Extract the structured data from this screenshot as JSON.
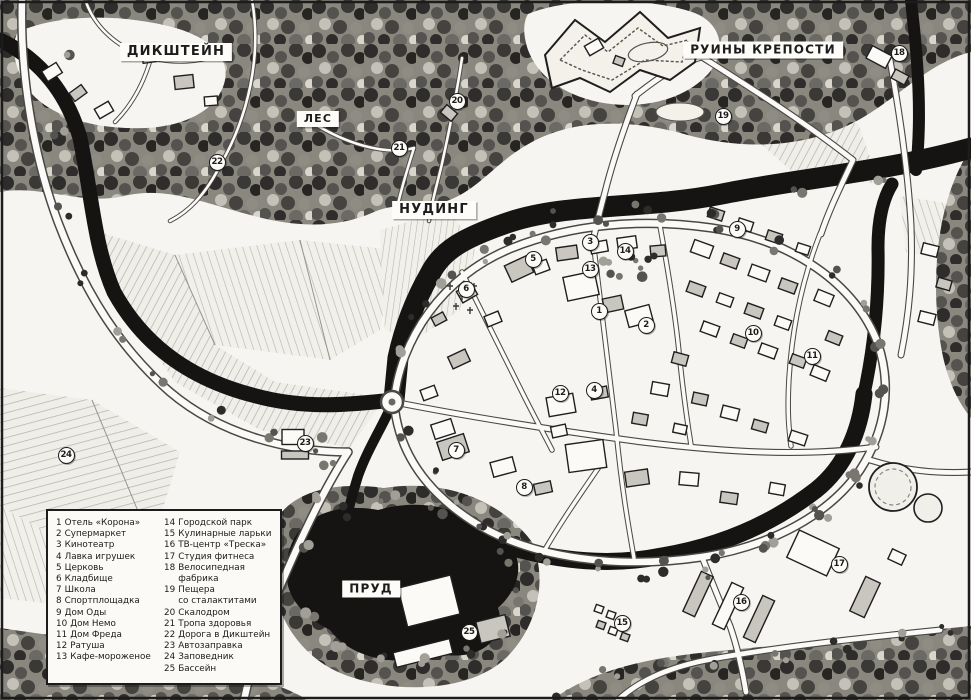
{
  "map": {
    "region_names": {
      "village": "ДИКШТЕЙН",
      "ruins": "РУИНЫ КРЕПОСТИ",
      "forest": "ЛЕС",
      "town": "НУДИНГ",
      "pond": "ПРУД"
    },
    "place_labels": [
      {
        "id": "dikshtein",
        "text": "ДИКШТЕЙН",
        "x": 176,
        "y": 52,
        "fs": 13
      },
      {
        "id": "fortress-ruins",
        "text": "РУИНЫ КРЕПОСТИ",
        "x": 763,
        "y": 50,
        "fs": 12
      },
      {
        "id": "forest",
        "text": "ЛЕС",
        "x": 318,
        "y": 119,
        "fs": 11
      },
      {
        "id": "nuding",
        "text": "НУДИНГ",
        "x": 434,
        "y": 210,
        "fs": 13
      },
      {
        "id": "pond",
        "text": "ПРУД",
        "x": 371,
        "y": 589,
        "fs": 12
      }
    ],
    "markers": [
      {
        "n": "1",
        "x": 599,
        "y": 311
      },
      {
        "n": "2",
        "x": 646,
        "y": 325
      },
      {
        "n": "3",
        "x": 590,
        "y": 242
      },
      {
        "n": "4",
        "x": 594,
        "y": 390
      },
      {
        "n": "5",
        "x": 533,
        "y": 259
      },
      {
        "n": "6",
        "x": 466,
        "y": 289
      },
      {
        "n": "7",
        "x": 456,
        "y": 450
      },
      {
        "n": "8",
        "x": 524,
        "y": 487
      },
      {
        "n": "9",
        "x": 737,
        "y": 229
      },
      {
        "n": "10",
        "x": 753,
        "y": 333
      },
      {
        "n": "11",
        "x": 812,
        "y": 356
      },
      {
        "n": "12",
        "x": 560,
        "y": 393
      },
      {
        "n": "13",
        "x": 590,
        "y": 269
      },
      {
        "n": "14",
        "x": 625,
        "y": 251
      },
      {
        "n": "15",
        "x": 622,
        "y": 623
      },
      {
        "n": "16",
        "x": 741,
        "y": 602
      },
      {
        "n": "17",
        "x": 839,
        "y": 564
      },
      {
        "n": "18",
        "x": 899,
        "y": 53
      },
      {
        "n": "19",
        "x": 723,
        "y": 116
      },
      {
        "n": "20",
        "x": 457,
        "y": 101
      },
      {
        "n": "21",
        "x": 399,
        "y": 148
      },
      {
        "n": "22",
        "x": 217,
        "y": 162
      },
      {
        "n": "23",
        "x": 305,
        "y": 443
      },
      {
        "n": "24",
        "x": 66,
        "y": 455
      },
      {
        "n": "25",
        "x": 469,
        "y": 632
      }
    ],
    "legend": {
      "items": [
        {
          "num": "1",
          "label": "Отель «Корона»"
        },
        {
          "num": "2",
          "label": "Супермаркет"
        },
        {
          "num": "3",
          "label": "Кинотеатр"
        },
        {
          "num": "4",
          "label": "Лавка игрушек"
        },
        {
          "num": "5",
          "label": "Церковь"
        },
        {
          "num": "6",
          "label": "Кладбище"
        },
        {
          "num": "7",
          "label": "Школа"
        },
        {
          "num": "8",
          "label": "Спортплощадка"
        },
        {
          "num": "9",
          "label": "Дом Оды"
        },
        {
          "num": "10",
          "label": "Дом Немо"
        },
        {
          "num": "11",
          "label": "Дом Фреда"
        },
        {
          "num": "12",
          "label": "Ратуша"
        },
        {
          "num": "13",
          "label": "Кафе-мороженое"
        },
        {
          "num": "14",
          "label": "Городской парк"
        },
        {
          "num": "15",
          "label": "Кулинарные ларьки"
        },
        {
          "num": "16",
          "label": "ТВ-центр «Треска»"
        },
        {
          "num": "17",
          "label": "Студия фитнеса"
        },
        {
          "num": "18",
          "label": "Велосипедная фабрика"
        },
        {
          "num": "19",
          "label": "Пещера\nсо сталактитами"
        },
        {
          "num": "20",
          "label": "Скалодром"
        },
        {
          "num": "21",
          "label": "Тропа здоровья"
        },
        {
          "num": "22",
          "label": "Дорога в Дикштейн"
        },
        {
          "num": "23",
          "label": "Автозаправка"
        },
        {
          "num": "24",
          "label": "Заповедник"
        },
        {
          "num": "25",
          "label": "Бассейн"
        }
      ]
    },
    "colors": {
      "ink": "#1c1c1c",
      "paper": "#f6f5f1",
      "water": "#151412"
    }
  }
}
